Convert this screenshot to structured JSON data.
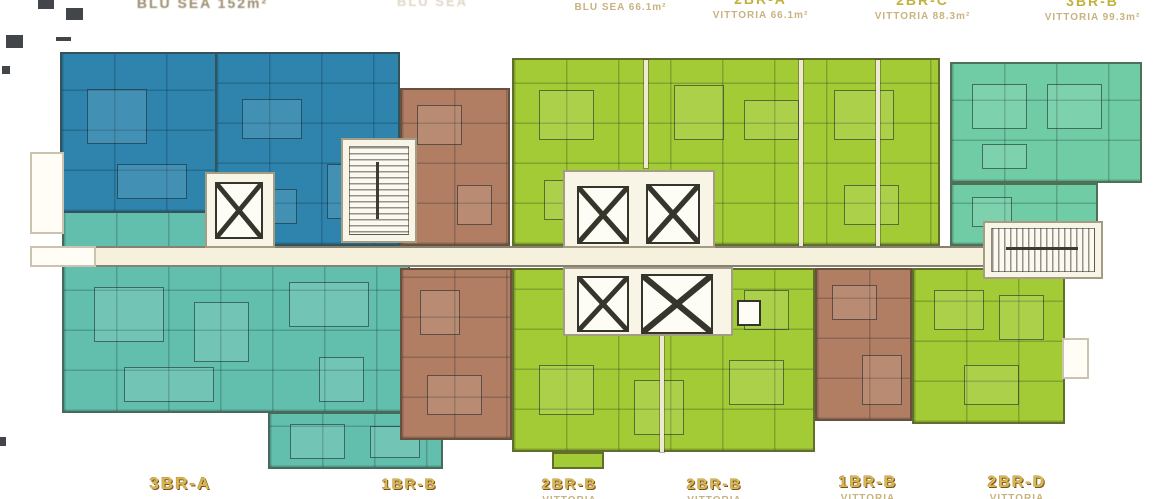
{
  "canvas": {
    "width": 1170,
    "height": 499,
    "background": "#ffffff"
  },
  "palette": {
    "blue": "#2e84ad",
    "teal": "#63bfad",
    "brown": "#b17e63",
    "lime": "#a3cb35",
    "mint": "#6fcca4",
    "corridor": "#f6f1dd",
    "core_cream": "#f8f4e6",
    "shaft_white": "#fdfcf5",
    "label_gold": "#d8b94e",
    "label_outline": "#7d5024",
    "label_tan": "#c2ab72",
    "type_yellow": "#c0b23c",
    "top_label_olive": "#8f7f5c",
    "top_label_ghost": "#dad3bf"
  },
  "top_labels": [
    {
      "type": "",
      "subtitle": "BLU SEA 152m²"
    },
    {
      "type": "",
      "subtitle": "BLU SEA"
    },
    {
      "type": "",
      "subtitle": "BLU SEA 66.1m²"
    },
    {
      "type": "2BR-A",
      "subtitle": "VITTORIA 66.1m²"
    },
    {
      "type": "2BR-C",
      "subtitle": "VITTORIA 88.3m²"
    },
    {
      "type": "3BR-B",
      "subtitle": "VITTORIA 99.3m²"
    }
  ],
  "bottom_labels": [
    {
      "type": "3BR-A",
      "subtitle": ""
    },
    {
      "type": "1BR-B",
      "subtitle": ""
    },
    {
      "type": "2BR-B",
      "subtitle": "VITTORIA"
    },
    {
      "type": "2BR-B",
      "subtitle": "VITTORIA"
    },
    {
      "type": "1BR-B",
      "subtitle": "VITTORIA"
    },
    {
      "type": "2BR-D",
      "subtitle": "VITTORIA"
    }
  ],
  "units": [
    {
      "name": "BLU SEA 3BR upper-left",
      "palette": "blue"
    },
    {
      "name": "3BR-A lower-left",
      "palette": "teal"
    },
    {
      "name": "1BR upper-left-center",
      "palette": "brown"
    },
    {
      "name": "1BR-B lower-left-center",
      "palette": "brown"
    },
    {
      "name": "2BR-A / 2BR-C upper cluster",
      "palette": "lime"
    },
    {
      "name": "2BR-B lower cluster",
      "palette": "lime"
    },
    {
      "name": "1BR-B lower-right",
      "palette": "brown"
    },
    {
      "name": "2BR-D lower-right",
      "palette": "lime"
    },
    {
      "name": "3BR-B upper-right",
      "palette": "mint"
    }
  ]
}
